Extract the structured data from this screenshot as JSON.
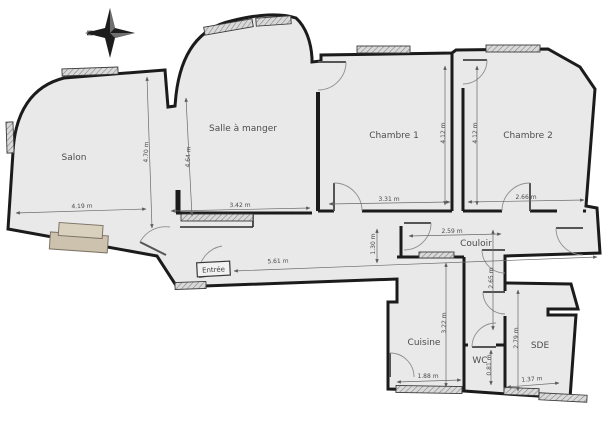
{
  "compass": {
    "north_label": "N"
  },
  "rooms": {
    "salon": {
      "label": "Salon"
    },
    "salle_a_manger": {
      "label": "Salle à manger"
    },
    "chambre1": {
      "label": "Chambre 1"
    },
    "chambre2": {
      "label": "Chambre 2"
    },
    "couloir": {
      "label": "Couloir"
    },
    "entree": {
      "label": "Entrée"
    },
    "cuisine": {
      "label": "Cuisine"
    },
    "wc": {
      "label": "WC"
    },
    "sde": {
      "label": "SDE"
    }
  },
  "dimensions": {
    "salon_width": "4.19 m",
    "salon_depth": "4.70 m",
    "salle_depth": "4.64 m",
    "salle_width": "3.42 m",
    "chambre1_width": "3.31 m",
    "chambre1_depth": "4.12 m",
    "chambre2_depth": "4.12 m",
    "chambre2_width": "2.66 m",
    "entree_length": "5.61 m",
    "hall_height": "1.30 m",
    "couloir_width": "2.59 m",
    "couloir_depth": "2.65 m",
    "cuisine_depth": "3.22 m",
    "cuisine_width": "1.88 m",
    "wc_depth": "0.81 m",
    "sde_depth": "2.79 m",
    "sde_width": "1.37 m"
  },
  "colors": {
    "wall": "#1b1b1b",
    "floor": "#e9e9e9",
    "dimension_line": "#6a6a6a",
    "fireplace": "#cdc2ae",
    "background": "#ffffff"
  }
}
